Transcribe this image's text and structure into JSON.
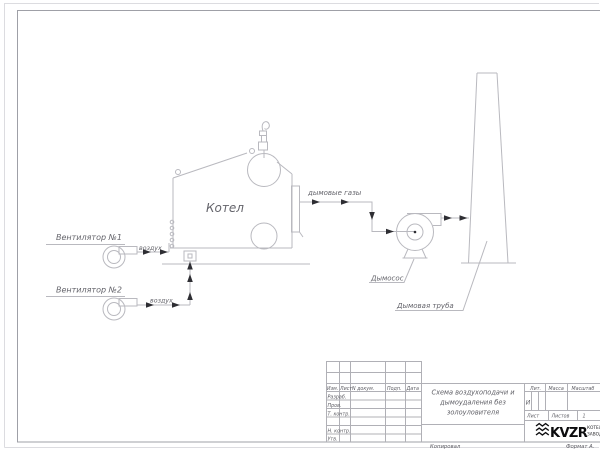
{
  "diagram": {
    "fan1_label": "Вентилятор №1",
    "fan2_label": "Вентилятор №2",
    "air1_label": "воздух",
    "air2_label": "воздух",
    "boiler_label": "Котел",
    "flue_gas_label": "дымовые газы",
    "exhauster_label": "Дымосос",
    "chimney_label": "Дымовая труба"
  },
  "title_block": {
    "header": {
      "izm": "Изм.",
      "list": "Лист",
      "doc": "N докум.",
      "sign": "Подп.",
      "date": "Дата"
    },
    "rows": {
      "developed": "Разраб.",
      "checked": "Пров.",
      "t_control": "Т. контр.",
      "n_control": "Н. контр.",
      "approved": "Утв."
    },
    "doc_title_line1": "Схема воздухоподачи и",
    "doc_title_line2": "дымоудаления без",
    "doc_title_line3": "золоуловителя",
    "lit_label": "Лит.",
    "lit_value": "И",
    "mass_label": "Масса",
    "scale_label": "Масштаб",
    "sheet_label": "Лист",
    "sheets_label": "Листов",
    "sheets_value": "1",
    "company": {
      "logo": "KVZR",
      "name_line1": "КОТЕЛЬНЫЙ",
      "name_line2": "ЗАВОД РЭ"
    }
  },
  "margins": {
    "copied": "Копировал",
    "format": "Формат А."
  },
  "colors": {
    "line": "#b9b9bf",
    "frame": "#9fa0a7",
    "text": "#64646b",
    "arrow": "#2e2e33",
    "logo": "#0c0c0e"
  }
}
